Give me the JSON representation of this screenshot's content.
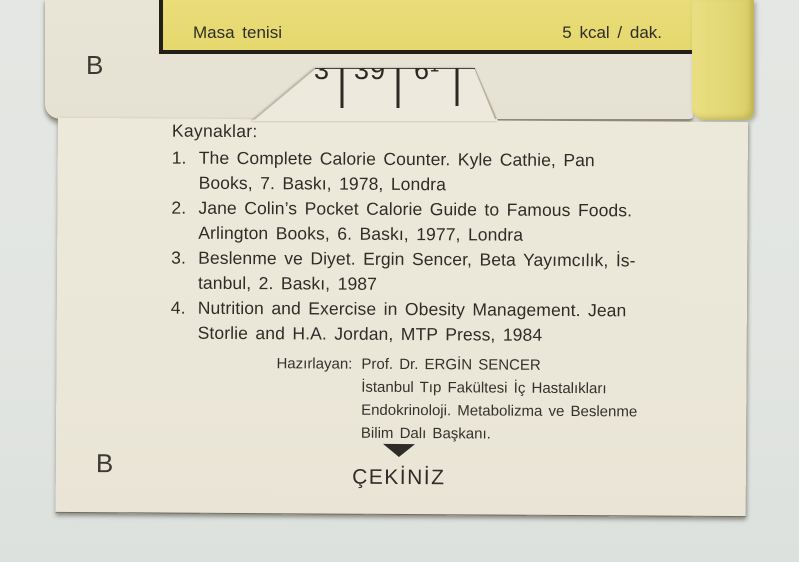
{
  "top_card": {
    "activity": "Masa tenisi",
    "rate": "5 kcal / dak."
  },
  "sleeve": {
    "label": "B"
  },
  "scale_tab": {
    "values": [
      "3",
      "39",
      "6¹"
    ]
  },
  "body_card": {
    "label": "B",
    "references": {
      "heading": "Kaynaklar:",
      "items": [
        {
          "number": "1.",
          "line1": "The Complete Calorie Counter. Kyle Cathie, Pan",
          "line2": "Books, 7. Baskı, 1978, Londra"
        },
        {
          "number": "2.",
          "line1": "Jane Colin’s Pocket Calorie Guide to Famous Foods.",
          "line2": "Arlington Books, 6. Baskı, 1977, Londra"
        },
        {
          "number": "3.",
          "line1": "Beslenme ve Diyet. Ergin Sencer, Beta Yayımcılık, İs-",
          "line2": "tanbul, 2. Baskı, 1987"
        },
        {
          "number": "4.",
          "line1": "Nutrition and Exercise in Obesity Management. Jean",
          "line2": "Storlie and H.A. Jordan, MTP Press, 1984"
        }
      ]
    },
    "author": {
      "label": "Hazırlayan:",
      "line1": "Prof. Dr. ERGİN SENCER",
      "line2": "İstanbul Tıp Fakültesi İç Hastalıkları",
      "line3": "Endokrinoloji. Metabolizma ve Beslenme",
      "line4": "Bilim Dalı Başkanı."
    },
    "pull": {
      "label": "ÇEKİNİZ",
      "arrow_icon": "pull-down-arrow"
    }
  },
  "colors": {
    "yellow": "#e6d972",
    "sleeve_paper": "#e6e2d4",
    "card_paper": "#ebe7d9",
    "background": "#e3e6e2",
    "ink": "#2c2a25"
  }
}
